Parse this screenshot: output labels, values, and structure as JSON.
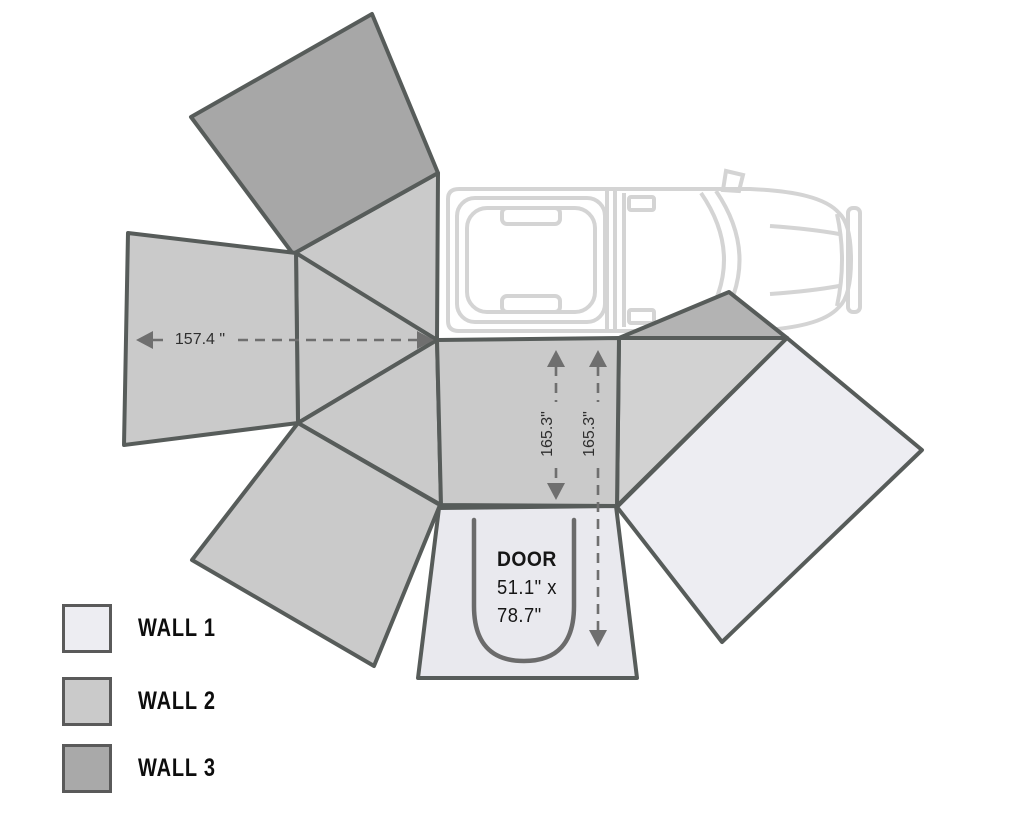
{
  "diagram_title": "awning-walls-layout",
  "legend": {
    "items": [
      {
        "label": "WALL 1",
        "color": "#ededf2"
      },
      {
        "label": "WALL 2",
        "color": "#cacaca"
      },
      {
        "label": "WALL 3",
        "color": "#a9a9a9"
      }
    ]
  },
  "dimensions": {
    "awning_width": "157.4 \"",
    "left_depth": "165.3\"",
    "right_depth": "165.3\""
  },
  "door": {
    "label": "DOOR",
    "width_line": "51.1\" x",
    "height_line": "78.7\""
  },
  "colors": {
    "wall1": "#ededf2",
    "wall2": "#cacaca",
    "wall3": "#a7a7a7",
    "awning_center_panel": "#cacaca",
    "awning_right_segment": "#d2d2d2",
    "awning_small_dark_segment": "#b3b3b3",
    "panel_outline": "#575c5a",
    "dimension_lines": "#6f6f6f",
    "vehicle_outline": "#d4d4d4"
  }
}
